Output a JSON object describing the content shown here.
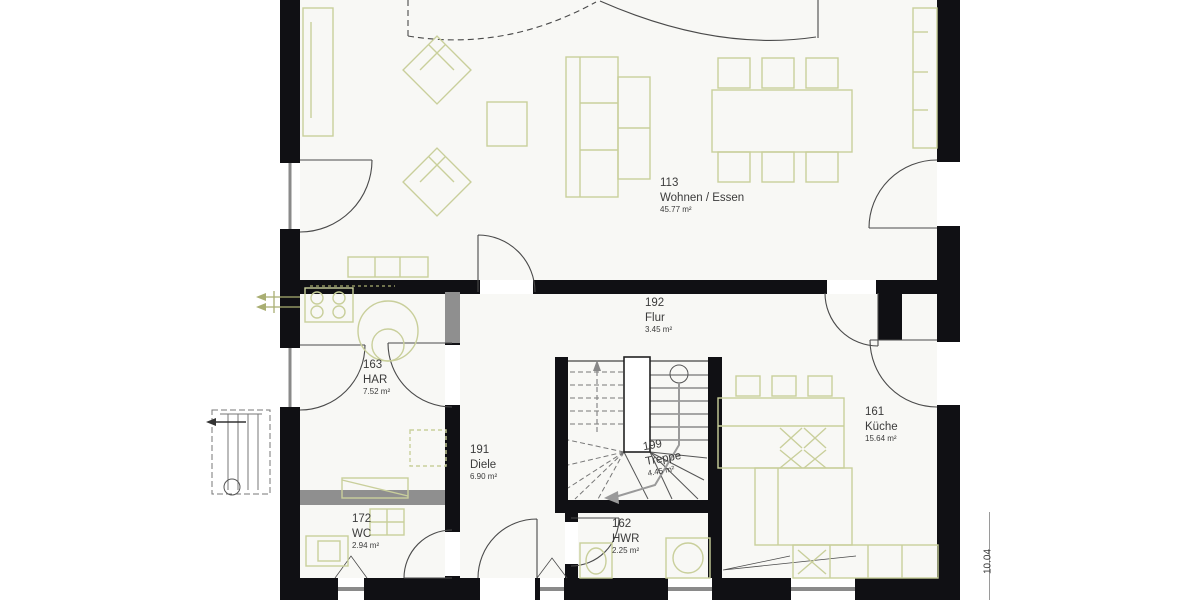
{
  "plan": {
    "title": "Erdgeschoss Grundriss",
    "rooms": [
      {
        "number": "113",
        "name": "Wohnen / Essen",
        "area": "45.77 m²"
      },
      {
        "number": "192",
        "name": "Flur",
        "area": "3.45 m²"
      },
      {
        "number": "163",
        "name": "HAR",
        "area": "7.52 m²"
      },
      {
        "number": "161",
        "name": "Küche",
        "area": "15.64 m²"
      },
      {
        "number": "191",
        "name": "Diele",
        "area": "6.90 m²"
      },
      {
        "number": "199",
        "name": "Treppe",
        "area": "4.45 m²"
      },
      {
        "number": "172",
        "name": "WC",
        "area": "2.94 m²"
      },
      {
        "number": "162",
        "name": "HWR",
        "area": "2.25 m²"
      }
    ],
    "dimensions": {
      "right_width_label": "10.04"
    },
    "colors": {
      "wall": "#101014",
      "light_wall": "#8f8f8f",
      "furniture": "#c9cf9b",
      "accent_green": "#a9ae72"
    }
  }
}
